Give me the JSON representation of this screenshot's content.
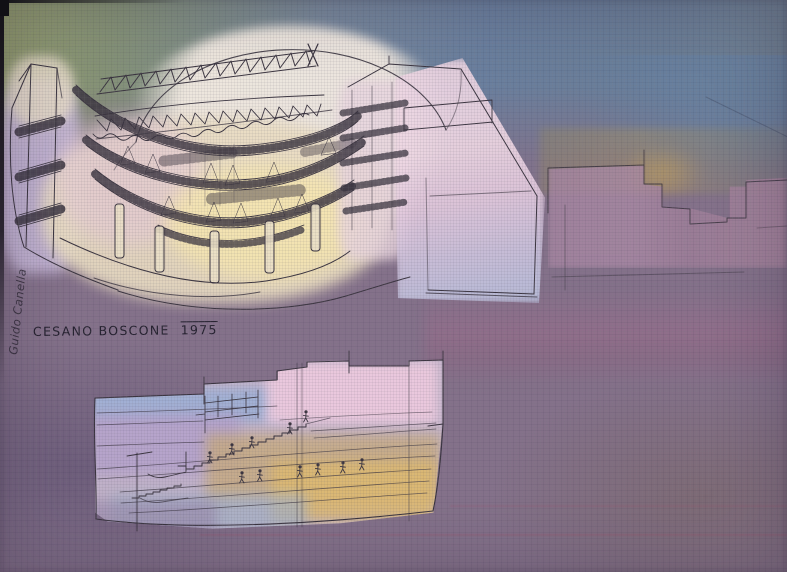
{
  "artwork": {
    "caption_location": "CESANO BOSCONE",
    "caption_year": "1975",
    "signature": "Guido Canella"
  },
  "palette": {
    "canvas_green": "#8e9a6e",
    "canvas_blue": "#68809d",
    "canvas_purple": "#84718a",
    "canvas_purple_dark": "#675a79",
    "wash_cream": "#e9dcc2",
    "wash_warm_yellow": "#f6e6b0",
    "wash_pink": "#ecd0e0",
    "wash_lavender": "#c0afd4",
    "wash_blue": "#a4b4d4",
    "wash_amber": "#deba70",
    "triangle_magenta": "#c9457f",
    "ink": "#3b3540"
  }
}
